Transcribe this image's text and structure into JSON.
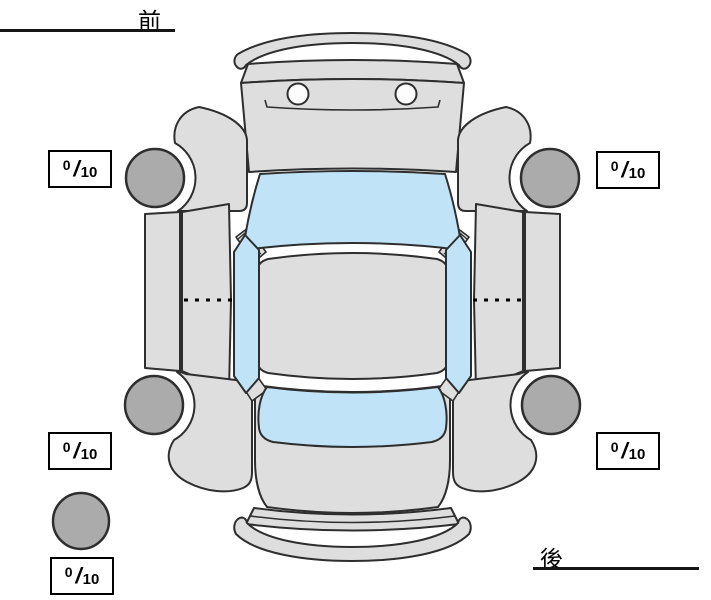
{
  "labels": {
    "front": "前",
    "rear": "後"
  },
  "score_boxes": {
    "front_left": {
      "value": "0",
      "separator": "/",
      "max": "10"
    },
    "front_right": {
      "value": "0",
      "separator": "/",
      "max": "10"
    },
    "rear_left": {
      "value": "0",
      "separator": "/",
      "max": "10"
    },
    "rear_right": {
      "value": "0",
      "separator": "/",
      "max": "10"
    },
    "spare": {
      "value": "0",
      "separator": "/",
      "max": "10"
    }
  },
  "colors": {
    "body": "#dedede",
    "window": "#c0e3f7",
    "tire": "#ababab",
    "outline": "#2e2e2e",
    "box_border": "#000000",
    "label": "#000000",
    "background": "#ffffff"
  }
}
